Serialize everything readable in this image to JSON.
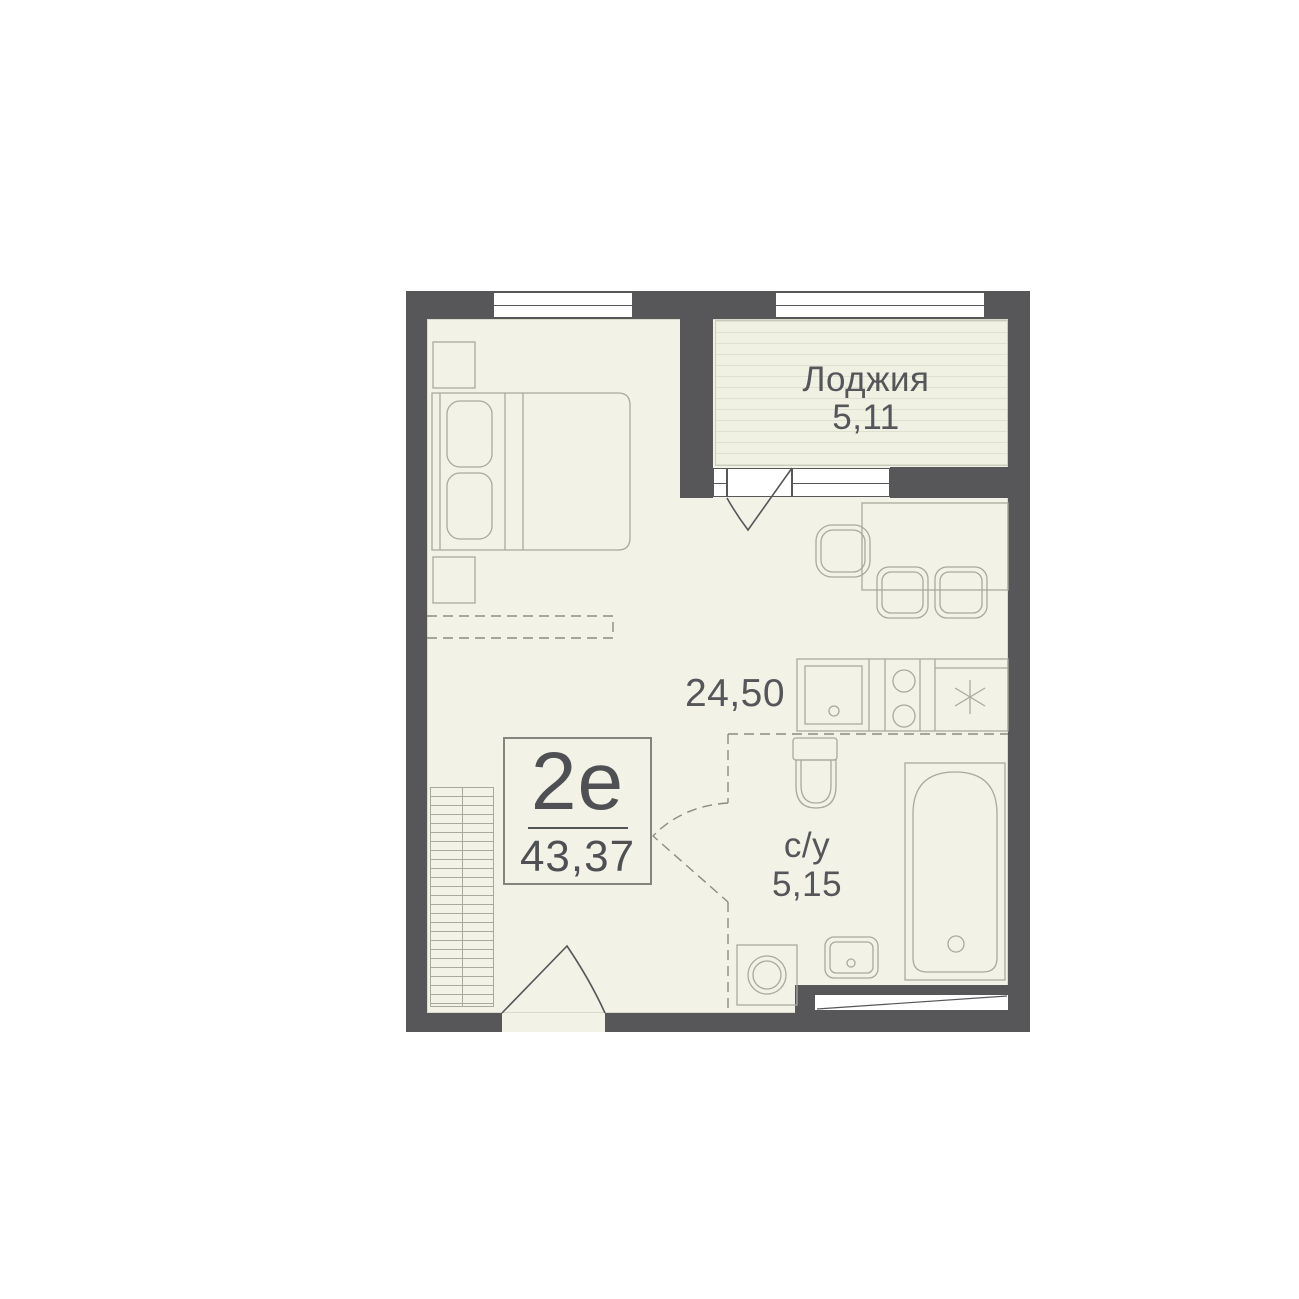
{
  "floor_plan": {
    "unit_card": {
      "type": "2е",
      "total_area": "43,37"
    },
    "rooms": {
      "loggia": {
        "name": "Лоджия",
        "area": "5,11"
      },
      "living": {
        "area": "24,50"
      },
      "bathroom": {
        "name": "с/у",
        "area": "5,15"
      }
    },
    "icons": {
      "fridge": "snowflake-icon"
    },
    "colors": {
      "wall": "#57575a",
      "floor": "#f2f2e6",
      "loggia_stripe": "#dfe0d1",
      "furniture_stroke": "#a8aa9c",
      "door_stroke": "#55565a",
      "text": "#55565a",
      "background": "#ffffff"
    }
  }
}
